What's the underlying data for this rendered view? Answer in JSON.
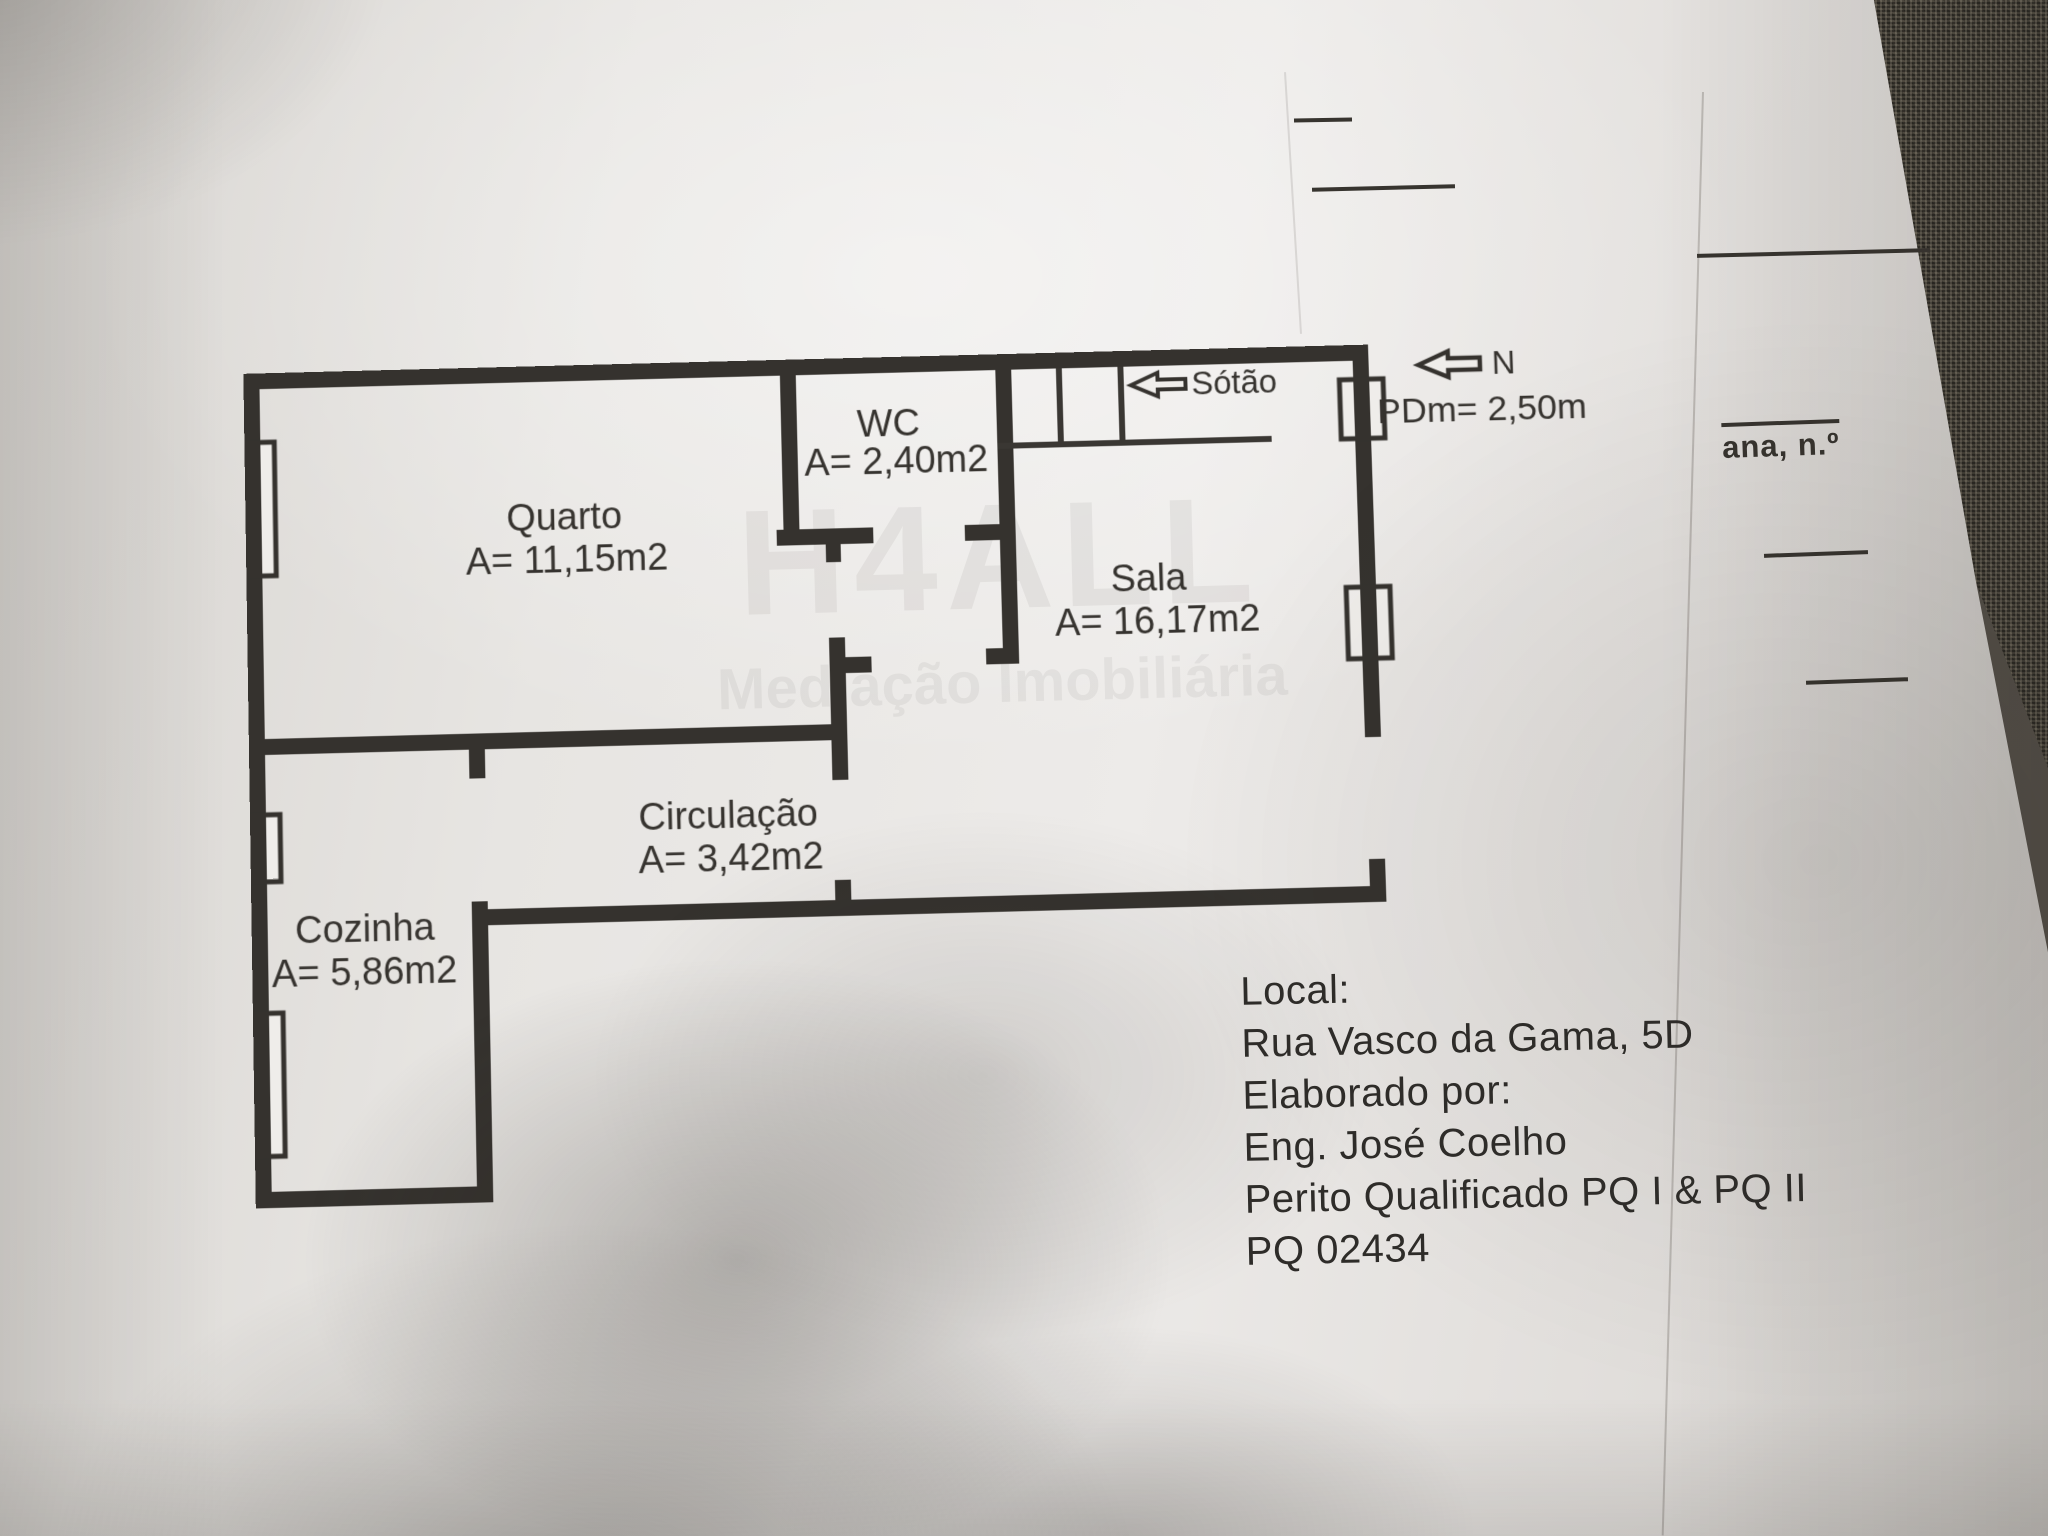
{
  "plan": {
    "rooms": [
      {
        "id": "quarto",
        "name": "Quarto",
        "area": "A= 11,15m2"
      },
      {
        "id": "wc",
        "name": "WC",
        "area": "A= 2,40m2"
      },
      {
        "id": "sala",
        "name": "Sala",
        "area": "A= 16,17m2"
      },
      {
        "id": "circulacao",
        "name": "Circulação",
        "area": "A= 3,42m2"
      },
      {
        "id": "cozinha",
        "name": "Cozinha",
        "area": "A= 5,86m2"
      }
    ],
    "attic_label": "Sótão",
    "north_label": "N",
    "ceiling_height_label": "PDm= 2,50m",
    "wall_color": "#35322e"
  },
  "info_block": {
    "lines": [
      "Local:",
      "Rua Vasco da Gama, 5D",
      "Elaborado por:",
      "Eng. José Coelho",
      "Perito Qualificado PQ I & PQ II",
      "PQ 02434"
    ]
  },
  "underlying_sheet": {
    "partial_text": "ana, n.º"
  },
  "watermark": {
    "line1": "H4ALL",
    "line2": "Mediação Imobiliária"
  }
}
